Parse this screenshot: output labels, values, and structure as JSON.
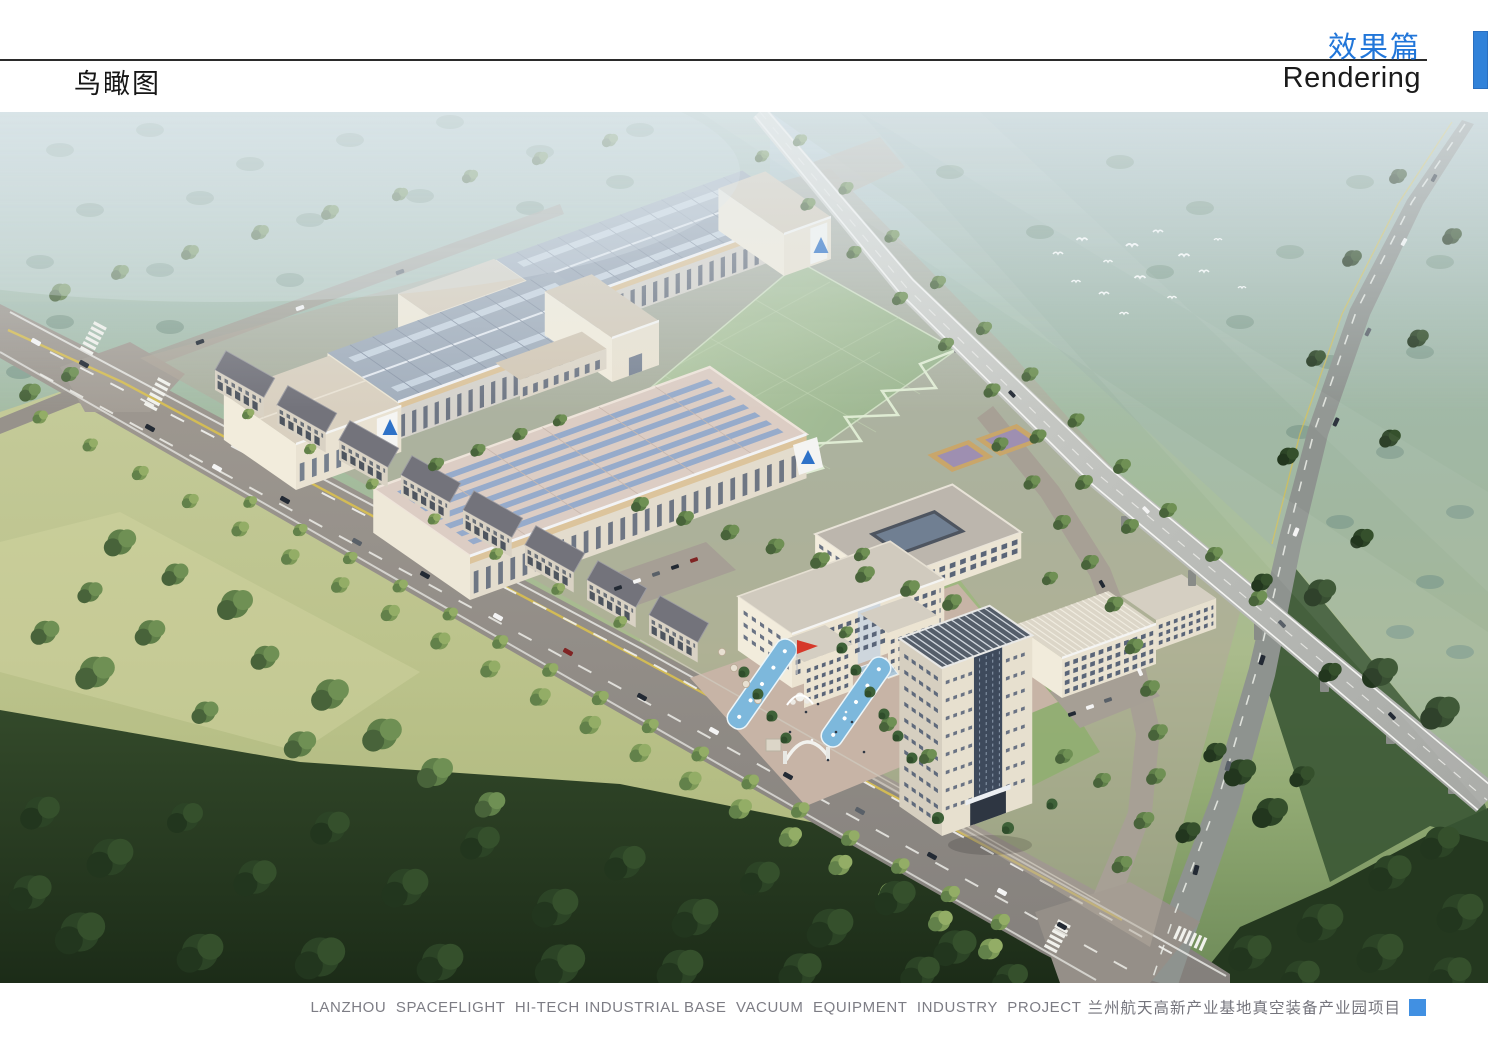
{
  "header": {
    "page_title": "鸟瞰图",
    "section_title_zh": "效果篇",
    "section_title_en": "Rendering"
  },
  "footer": {
    "caption_en": "LANZHOU  SPACEFLIGHT  HI-TECH INDUSTRIAL BASE  VACUUM  EQUIPMENT  INDUSTRY  PROJECT",
    "caption_zh": "兰州航天高新产业基地真空装备产业园项目"
  },
  "colors": {
    "section_title_blue": "#2176d9",
    "accent_bar_blue": "#3182d9",
    "footer_square_blue": "#4190e2",
    "divider_black": "#2b2b2b",
    "caption_gray": "#7d7d85"
  }
}
